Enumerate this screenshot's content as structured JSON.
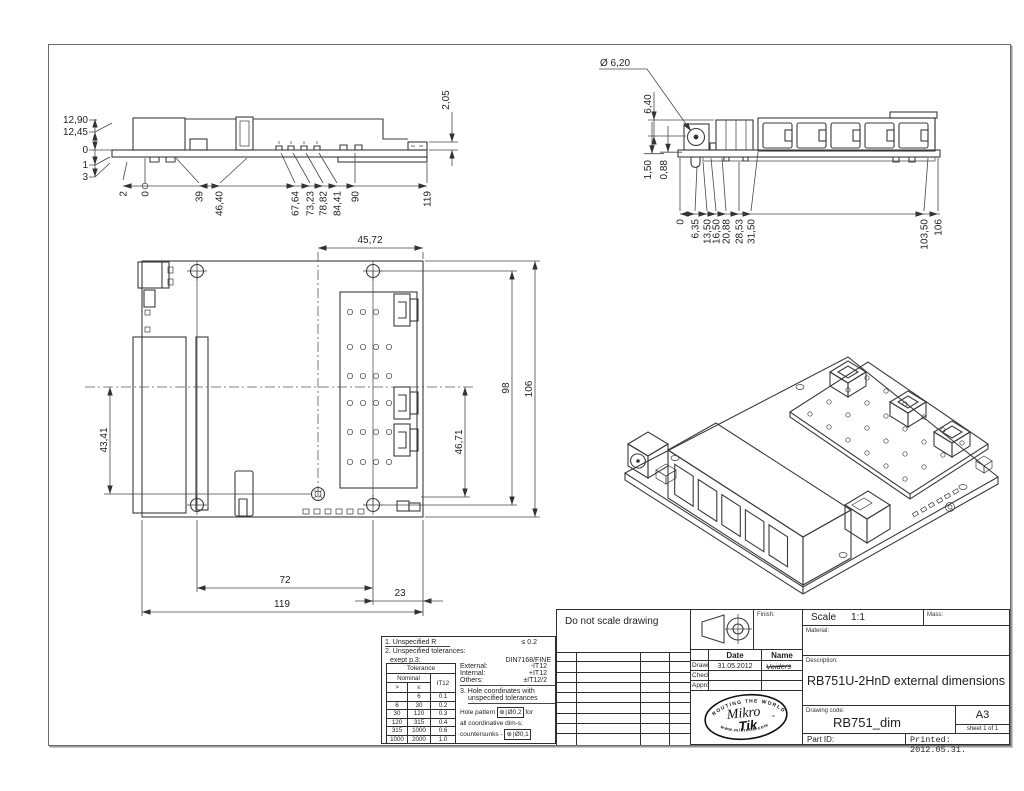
{
  "dims": {
    "side": {
      "stack": [
        "12,90",
        "12,45",
        "0",
        "1",
        "3"
      ],
      "bottom": [
        "2",
        "0",
        "39",
        "46,40",
        "67,64",
        "73,23",
        "78,82",
        "84,41",
        "90",
        "119"
      ],
      "right": "2,05"
    },
    "front": {
      "diameter": "Ø 6,20",
      "height": "6,40",
      "drop1": "1,50",
      "drop2": "0,88",
      "bottom": [
        "0",
        "6,35",
        "13,50",
        "16,50",
        "20,88",
        "28,53",
        "31,50",
        "103,50",
        "106"
      ]
    },
    "top": {
      "width": "45,72",
      "holes": "98",
      "height": "106",
      "left": "43,41",
      "inner": "46,71",
      "b1": "72",
      "b2": "119",
      "b3": "23"
    }
  },
  "notes": {
    "r1a": "1. Unspecified R",
    "r1b": "≤  0.2",
    "r2a": "2. Unspecified tolerances:",
    "r2b": "exept p.3:",
    "r2c": "DIN7168/FINE",
    "tol": {
      "title": "Tolerance",
      "nominal": "Nominal",
      "it": "IT12",
      "gt": ">",
      "lt": "≤",
      "rows": [
        [
          "",
          "6",
          "0.1"
        ],
        [
          "6",
          "30",
          "0.2"
        ],
        [
          "30",
          "120",
          "0.3"
        ],
        [
          "120",
          "315",
          "0.4"
        ],
        [
          "315",
          "1000",
          "0.6"
        ],
        [
          "1000",
          "2000",
          "1.0"
        ]
      ]
    },
    "ext_l": "External:",
    "ext_v": "-IT12",
    "int_l": "Internal:",
    "int_v": "+IT12",
    "oth_l": "Others:",
    "oth_v": "±IT12/2",
    "n3a": "3. Hole coordinates with",
    "n3b": "unspecified tolerances",
    "hp1": "Hole pattern",
    "hp_sym": "⊕",
    "hp_tol": "Ø0,2",
    "hp2": "for",
    "coord": "all coordinative dim-s;",
    "cs1": "countersunks -",
    "cs_sym": "⊕",
    "cs_tol": "Ø0,1"
  },
  "tb": {
    "dns": "Do not scale drawing",
    "finish": "Finish:",
    "date_h": "Date",
    "name_h": "Name",
    "drawn_l": "Drawn.",
    "drawn_date": "31.05.2012",
    "drawn_name": "Veiders",
    "check_l": "Check.",
    "appr_l": "Approw.",
    "scale_l": "Scale",
    "scale_v": "1:1",
    "mass_l": "Mass:",
    "material_l": "Material:",
    "desc_l": "Description:",
    "desc_v": "RB751U-2HnD external dimensions",
    "code_l": "Drawing code:",
    "code_v": "RB751_dim",
    "size": "A3",
    "sheet": "sheet 1 of 1",
    "part_l": "Part ID:",
    "printed": "Printed: 2012.05.31.",
    "logo": {
      "arc_top": "ROUTING THE WORLD",
      "m1": "Mikro",
      "m2": "Tik",
      "tm": "™",
      "arc_bot": "www.mikrotik.com"
    }
  }
}
